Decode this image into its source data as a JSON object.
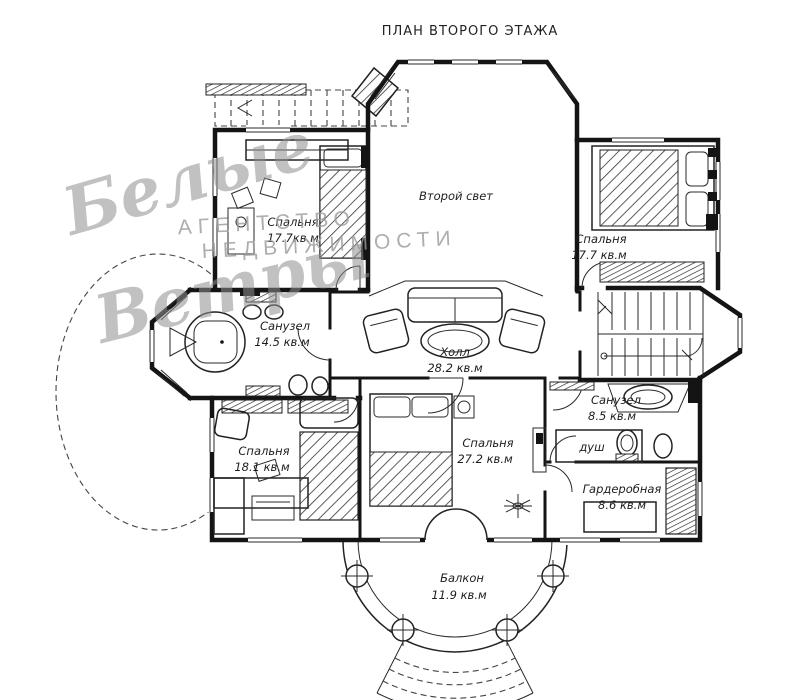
{
  "title": "ПЛАН ВТОРОГО ЭТАЖА",
  "watermark": {
    "script_line1": "Белые",
    "script_line2": "Ветры",
    "caps_line1": "АГЕНТСТВО",
    "caps_line2": "НЕДВИЖИМОСТИ"
  },
  "rooms": {
    "bedroom_tl": {
      "name": "Спальня",
      "area": "17.7кв.м"
    },
    "second_light": {
      "name": "Второй свет",
      "area": ""
    },
    "bedroom_tr": {
      "name": "Спальня",
      "area": "17.7 кв.м"
    },
    "bath_left": {
      "name": "Санузел",
      "area": "14.5 кв.м"
    },
    "hall": {
      "name": "Холл",
      "area": "28.2 кв.м"
    },
    "bedroom_bl": {
      "name": "Спальня",
      "area": "18.1 кв.м"
    },
    "bedroom_bc": {
      "name": "Спальня",
      "area": "27.2 кв.м"
    },
    "bath_right": {
      "name": "Санузел",
      "area": "8.5 кв.м"
    },
    "shower": {
      "name": "душ",
      "area": ""
    },
    "wardrobe": {
      "name": "Гардеробная",
      "area": "8.6 кв.м"
    },
    "balcony": {
      "name": "Балкон",
      "area": "11.9 кв.м"
    }
  },
  "colors": {
    "line": "#141414",
    "watermark_gray": "#9b9b9b",
    "background": "#ffffff"
  }
}
